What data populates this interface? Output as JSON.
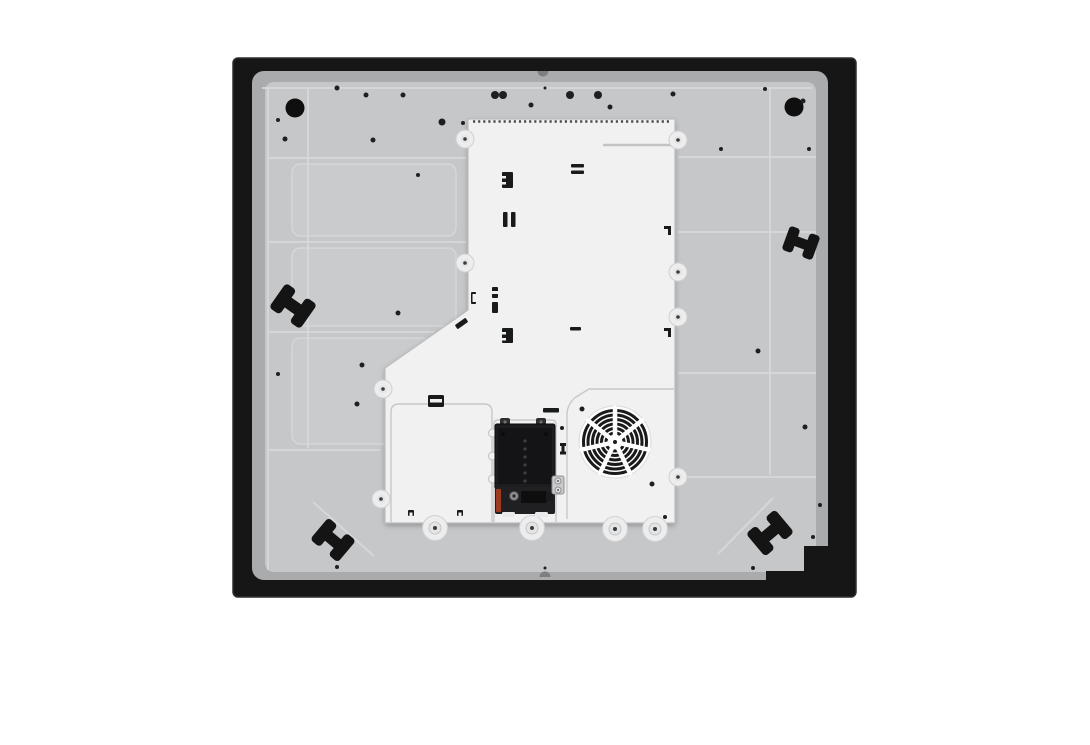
{
  "scene": {
    "label": "appliance-underside-product-photo",
    "subject": "induction-hob-bottom-view",
    "width": 1090,
    "height": 745
  },
  "colors": {
    "page": "#ffffff",
    "frame": "#161616",
    "frameEdge": "#2e2e2e",
    "under": "#a9abad",
    "panel": "#c6c7c9",
    "cell": "#cacbcd",
    "rib": "#d8d9db",
    "crease": "#d6d7d9",
    "hole": "#0f0f10",
    "dot": "#1f1f20",
    "white": "#f1f1f2",
    "whiteEdge": "#bcbdbf",
    "whiteLine": "#c7c8ca",
    "serration": "#4b4b4d",
    "groove": "#c2c3c5",
    "bossFill": "#ededee",
    "bossRing": "#cfd0d2",
    "bossMid": "#e3e4e5",
    "bossDot": "#3b3b3d",
    "mark": "#191a1b",
    "clip": "#141415",
    "notch": "#7e7f81",
    "fanRing": "#1a1a1b"
  },
  "frame": {
    "x": 233,
    "y": 58,
    "w": 623,
    "h": 539,
    "rx": 5,
    "steps": [
      [
        804,
        546,
        30,
        36
      ],
      [
        766,
        571,
        42,
        12
      ]
    ]
  },
  "underlayer": {
    "x": 252,
    "y": 71,
    "w": 576,
    "h": 509,
    "rx": 12
  },
  "panel": {
    "x": 265,
    "y": 82,
    "w": 551,
    "h": 490,
    "rx": 9,
    "ribs": [
      [
        268,
        158,
        466,
        158
      ],
      [
        268,
        242,
        466,
        242
      ],
      [
        268,
        332,
        434,
        332
      ],
      [
        268,
        450,
        380,
        450
      ],
      [
        678,
        157,
        816,
        157
      ],
      [
        678,
        232,
        816,
        232
      ],
      [
        678,
        373,
        816,
        373
      ],
      [
        682,
        477,
        816,
        477
      ],
      [
        308,
        88,
        308,
        448
      ],
      [
        770,
        88,
        770,
        475
      ],
      [
        268,
        88,
        268,
        570
      ],
      [
        262,
        88,
        812,
        88
      ]
    ],
    "cells": [
      [
        292,
        164,
        164,
        72
      ],
      [
        292,
        248,
        164,
        78
      ],
      [
        292,
        338,
        138,
        106
      ]
    ],
    "creases": [
      [
        313,
        502,
        374,
        556
      ],
      [
        773,
        498,
        718,
        554
      ]
    ],
    "holes": [
      [
        295,
        108,
        9.5
      ],
      [
        794,
        107,
        9.5
      ]
    ],
    "dots": [
      [
        337,
        88,
        2.5
      ],
      [
        366,
        95,
        2.5
      ],
      [
        403,
        95,
        2.5
      ],
      [
        442,
        122,
        3.5
      ],
      [
        463,
        123,
        2
      ],
      [
        495,
        95,
        4
      ],
      [
        503,
        95,
        4
      ],
      [
        531,
        105,
        2.5
      ],
      [
        545,
        88,
        1.5
      ],
      [
        570,
        95,
        4
      ],
      [
        598,
        95,
        4
      ],
      [
        610,
        107,
        2.5
      ],
      [
        673,
        94,
        2.5
      ],
      [
        765,
        89,
        2
      ],
      [
        803,
        101,
        2.5
      ],
      [
        721,
        149,
        2
      ],
      [
        809,
        149,
        2
      ],
      [
        278,
        120,
        2
      ],
      [
        285,
        139,
        2.5
      ],
      [
        373,
        140,
        2.5
      ],
      [
        418,
        175,
        2
      ],
      [
        398,
        313,
        2.5
      ],
      [
        362,
        365,
        2.5
      ],
      [
        357,
        404,
        2.5
      ],
      [
        278,
        374,
        2
      ],
      [
        758,
        351,
        2.5
      ],
      [
        805,
        427,
        2.5
      ],
      [
        820,
        505,
        2
      ],
      [
        337,
        567,
        2
      ],
      [
        545,
        568,
        1.5
      ],
      [
        753,
        568,
        2
      ],
      [
        813,
        537,
        2
      ]
    ],
    "notches": [
      "M537.5,71 A5.5,5.5 0 0 0 548.5,71 Z",
      "M539.5,577 A5.5,5.5 0 0 1 550.5,577 Z"
    ],
    "clips": [
      {
        "x": 293,
        "y": 306,
        "rot": 35,
        "s": 1.0
      },
      {
        "x": 801,
        "y": 243,
        "rot": 20,
        "s": 0.85
      },
      {
        "x": 333,
        "y": 540,
        "rot": 40,
        "s": 0.95
      },
      {
        "x": 770,
        "y": 533,
        "rot": -40,
        "s": 1.0
      }
    ]
  },
  "cover": {
    "outline": "M468,119 L675,119 L675,523 L385,523 L385,368 L468,310 Z",
    "serration": {
      "x1": 473,
      "x2": 671,
      "y": 121.5,
      "dash": "2.2 2.9"
    },
    "groove": [
      603,
      145,
      671,
      145
    ],
    "subpanels": [
      "M391,523 L391,412 Q391,404 399,404 L484,404 Q492,404 492,412 L492,523",
      "M494,522 L494,424 Q494,420 498,420 L552,420 Q556,420 556,424 L556,522",
      "M567,519 L567,415 Q567,404 576,397 L589,389 L674,389"
    ],
    "bumps": [
      [
        492.5,
        433
      ],
      [
        492.5,
        456
      ],
      [
        492.5,
        479
      ]
    ],
    "bosses_small": [
      [
        465,
        139
      ],
      [
        465,
        263
      ],
      [
        383,
        389
      ],
      [
        381,
        499
      ],
      [
        678,
        140
      ],
      [
        678,
        272
      ],
      [
        678,
        317
      ],
      [
        678,
        477
      ]
    ],
    "bosses_large": [
      [
        435,
        528
      ],
      [
        532,
        528
      ],
      [
        615,
        529
      ],
      [
        655,
        529
      ]
    ],
    "marks_black": [
      [
        502,
        172,
        11,
        16,
        1,
        0
      ],
      [
        571,
        164,
        13,
        3.5,
        1,
        0
      ],
      [
        571,
        170.5,
        13,
        3.5,
        1,
        0
      ],
      [
        503,
        212,
        4.5,
        15,
        1,
        0
      ],
      [
        511,
        212,
        4.5,
        15,
        1,
        0
      ],
      [
        492,
        287,
        6,
        11,
        1,
        0
      ],
      [
        492,
        302,
        6,
        11,
        1,
        0
      ],
      [
        471,
        292,
        5,
        12,
        1,
        0
      ],
      [
        502,
        328,
        11,
        15,
        1,
        0
      ],
      [
        570,
        327,
        11,
        3.5,
        1,
        0
      ],
      [
        664,
        226,
        7,
        3,
        0,
        0
      ],
      [
        668,
        228,
        3,
        7,
        0,
        0
      ],
      [
        664,
        328,
        7,
        3,
        0,
        0
      ],
      [
        668,
        330,
        3,
        7,
        0,
        0
      ],
      [
        455,
        321,
        13,
        5,
        1,
        -35
      ],
      [
        428,
        395,
        16,
        12,
        1.5,
        0
      ],
      [
        543,
        408,
        16,
        4.5,
        1,
        0
      ],
      [
        560,
        443,
        6,
        3,
        0,
        0
      ],
      [
        561.5,
        446,
        3,
        6,
        0,
        0
      ],
      [
        560,
        451.5,
        6,
        3,
        0,
        0
      ],
      [
        408,
        510,
        6,
        6,
        1,
        0
      ],
      [
        457,
        510,
        6,
        6,
        1,
        0
      ]
    ],
    "marks_white": [
      [
        502,
        176,
        4,
        2.5
      ],
      [
        502,
        182,
        4,
        2.5
      ],
      [
        492,
        291,
        6,
        3
      ],
      [
        472.5,
        294,
        3.5,
        8
      ],
      [
        502,
        332,
        4,
        2.5
      ],
      [
        502,
        338,
        4,
        2.5
      ],
      [
        430,
        399,
        12,
        3.5
      ],
      [
        409.5,
        512.5,
        3,
        3.5
      ],
      [
        458.5,
        512.5,
        3,
        3.5
      ]
    ],
    "dots": [
      [
        665,
        517,
        2
      ],
      [
        562,
        428,
        2
      ]
    ]
  },
  "terminal": {
    "rects": [
      [
        500,
        418,
        10,
        8,
        2,
        "#2e2e30",
        ""
      ],
      [
        536,
        418,
        10,
        8,
        2,
        "#2e2e30",
        ""
      ],
      [
        495,
        424,
        60,
        65,
        2,
        "#1d1d1f",
        "#0a0a0b"
      ],
      [
        498,
        428,
        54,
        56,
        1,
        "#141416",
        ""
      ],
      [
        495,
        487,
        60,
        27,
        2,
        "#202022",
        ""
      ],
      [
        496,
        489,
        5,
        23,
        1,
        "#9c3b22",
        ""
      ],
      [
        521,
        491,
        26,
        12,
        1,
        "#0e0e0f",
        ""
      ],
      [
        546,
        492,
        7,
        9,
        1,
        "#1a1a1c",
        ""
      ],
      [
        502,
        512,
        13,
        5,
        1.5,
        "#e8e9ea",
        ""
      ],
      [
        535,
        512,
        13,
        5,
        1.5,
        "#e8e9ea",
        ""
      ],
      [
        552,
        476,
        12,
        18,
        2,
        "#c9cacc",
        "#8f9092"
      ]
    ],
    "circles": [
      [
        505,
        422,
        1.6,
        "#6e6f71",
        ""
      ],
      [
        541,
        422,
        1.6,
        "#6e6f71",
        ""
      ],
      [
        503,
        434,
        1.8,
        "#0b0b0c",
        ""
      ],
      [
        546,
        434,
        1.8,
        "#0b0b0c",
        ""
      ],
      [
        514,
        496,
        4.5,
        "#8c8d8f",
        "#4a4a4c"
      ],
      [
        514,
        496,
        1.6,
        "#2a2a2b",
        ""
      ],
      [
        558,
        481,
        3,
        "#e0e1e2",
        "#8f9092"
      ],
      [
        558,
        490,
        3,
        "#e0e1e2",
        "#8f9092"
      ],
      [
        558,
        481,
        1,
        "#555658",
        ""
      ],
      [
        558,
        490,
        1,
        "#555658",
        ""
      ]
    ],
    "dot_column": {
      "x": 525,
      "y0": 441,
      "step": 8,
      "count": 6,
      "r": 1.6,
      "fill": "#3f3f41"
    }
  },
  "fan": {
    "cx": 615,
    "cy": 442,
    "rings": [
      9,
      13.5,
      18,
      22.5,
      27,
      31.5
    ],
    "ring_width": 3,
    "spokes": 7,
    "spoke_width": 4.5,
    "spoke_inner": 3,
    "spoke_outer": 34.5,
    "hub_r": 4.5,
    "hub_dot": 2,
    "outer_r": 36,
    "screws": [
      [
        582,
        409,
        2.5
      ],
      [
        652,
        484,
        2.5
      ]
    ]
  }
}
